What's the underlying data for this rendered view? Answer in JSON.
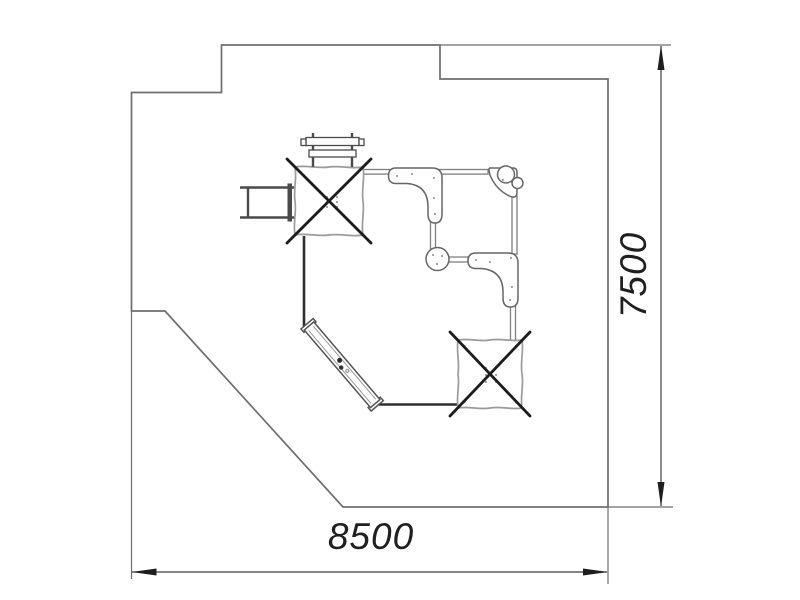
{
  "drawing": {
    "type": "playground-site-plan",
    "dimensions": {
      "width_label": "8500",
      "height_label": "7500"
    },
    "colors": {
      "background": "#ffffff",
      "boundary_line": "#6e6e6e",
      "dimension_line": "#3f3f3f",
      "arrowhead": "#1e1e1e",
      "text": "#1f1f1f",
      "equipment_rail": "#7f7f7f",
      "equipment_outline": "#666666",
      "canvas_edge": "#9b9b9b",
      "cross_mark": "#1c1c1c",
      "rope_edge": "#2f2f2f"
    },
    "symbols": [
      "crossed-canopy-platform-icon",
      "overhead-ladder-icon",
      "entry-ladder-icon",
      "curved-panel-icon",
      "corner-pole-platform-icon",
      "round-platform-icon",
      "slide-icon",
      "rail-icon",
      "rope-edge-icon"
    ]
  }
}
